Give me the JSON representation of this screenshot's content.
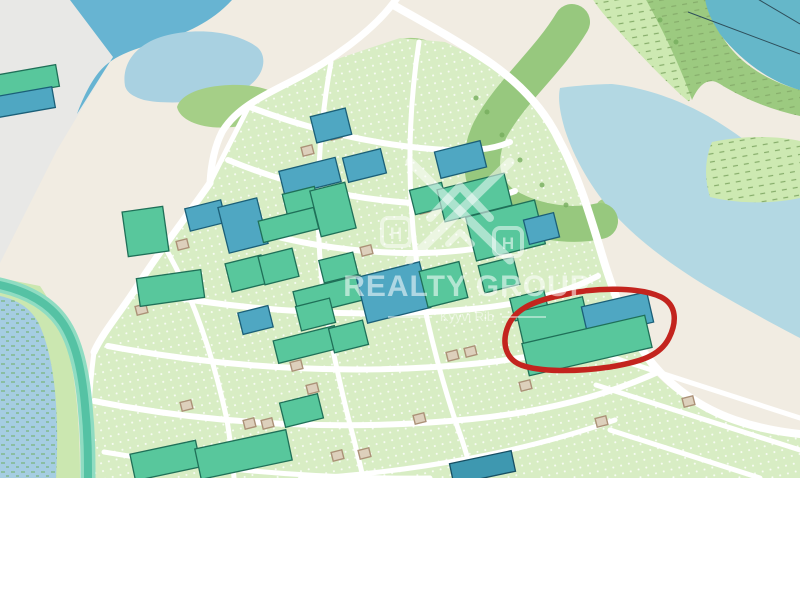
{
  "map": {
    "kind": "street-map-screenshot",
    "viewport": {
      "width": 800,
      "height": 478
    },
    "watermark": {
      "title": "REALTY GROUP",
      "subtitle": "Kyyvi Rib",
      "logo": "double-roof-x-with-H-badges",
      "color": "#ffffff"
    },
    "annotation": {
      "type": "hand-drawn-ellipse",
      "color": "#c3241e",
      "path": "M563,295 C595,287 640,287 661,297 C677,305 677,322 669,338 C660,356 640,362 610,367 C575,372 540,372 521,365 C506,359 502,344 507,329 C513,310 532,301 563,295 Z"
    },
    "colors": {
      "terrain": "#f1ece2",
      "industrial": "#e8e8e6",
      "water_dark": "#67b4d2",
      "pond": "#a9d1e1",
      "grass": "#a5cf87",
      "scrub": "#cde9b2",
      "bank": "#9cca80",
      "bank_band": "#97c87e",
      "water_teal": "#65b7c9",
      "river": "#b3d8e3",
      "plots": "#d8edc4",
      "wetland_blue": "#a5cde2",
      "wetland_green": "#cbe7b0",
      "canal": "#55c2a4",
      "canal_edge": "#8fdcc2",
      "road": "#ffffff",
      "building_green": "#58c79c",
      "building_green_stroke": "#1f7058",
      "building_blue": "#4fa7c2",
      "building_blue_stroke": "#1b5f78",
      "building_dark": "#3e98b0",
      "building_dark_stroke": "#174f63",
      "shed_fill": "#ddd0bc",
      "shed_stroke": "#ab9177",
      "annotation_red": "#c3241e",
      "cable": "#2e4e5a",
      "page_background": "#ffffff"
    },
    "buildings": [
      [
        313,
        112,
        36,
        27,
        -14,
        "b"
      ],
      [
        281,
        164,
        58,
        25,
        -14,
        "b"
      ],
      [
        345,
        153,
        39,
        25,
        -14,
        "b"
      ],
      [
        437,
        146,
        47,
        27,
        -14,
        "b"
      ],
      [
        187,
        204,
        37,
        23,
        -14,
        "b"
      ],
      [
        223,
        202,
        40,
        47,
        -14,
        "b"
      ],
      [
        285,
        190,
        33,
        27,
        -14,
        "g"
      ],
      [
        315,
        186,
        36,
        47,
        -14,
        "g"
      ],
      [
        260,
        214,
        57,
        22,
        -14,
        "g"
      ],
      [
        412,
        186,
        33,
        25,
        -14,
        "g"
      ],
      [
        440,
        181,
        69,
        33,
        -14,
        "g"
      ],
      [
        470,
        208,
        71,
        45,
        -14,
        "g"
      ],
      [
        526,
        216,
        31,
        25,
        -14,
        "b"
      ],
      [
        125,
        209,
        41,
        45,
        -8,
        "g"
      ],
      [
        138,
        274,
        65,
        28,
        -8,
        "g"
      ],
      [
        228,
        259,
        37,
        29,
        -14,
        "g"
      ],
      [
        261,
        252,
        35,
        29,
        -14,
        "g"
      ],
      [
        321,
        256,
        35,
        23,
        -14,
        "g"
      ],
      [
        295,
        283,
        69,
        25,
        -14,
        "g"
      ],
      [
        298,
        302,
        35,
        25,
        -14,
        "g"
      ],
      [
        240,
        309,
        31,
        22,
        -14,
        "b"
      ],
      [
        275,
        333,
        63,
        23,
        -14,
        "g"
      ],
      [
        331,
        324,
        35,
        25,
        -14,
        "g"
      ],
      [
        361,
        269,
        65,
        47,
        -14,
        "b"
      ],
      [
        423,
        266,
        41,
        37,
        -14,
        "g"
      ],
      [
        481,
        261,
        36,
        28,
        -14,
        "g"
      ],
      [
        282,
        398,
        39,
        25,
        -14,
        "g"
      ],
      [
        132,
        447,
        67,
        27,
        -12,
        "g"
      ],
      [
        197,
        439,
        93,
        31,
        -12,
        "g"
      ],
      [
        451,
        457,
        63,
        21,
        -12,
        "d"
      ],
      [
        512,
        294,
        35,
        23,
        -14,
        "g"
      ],
      [
        519,
        304,
        68,
        33,
        -13,
        "g"
      ],
      [
        584,
        299,
        67,
        31,
        -13,
        "b"
      ],
      [
        524,
        329,
        126,
        33,
        -13,
        "g"
      ],
      [
        -6,
        70,
        64,
        22,
        -10,
        "g"
      ],
      [
        -8,
        92,
        62,
        21,
        -10,
        "b"
      ]
    ],
    "sheds": [
      [
        177,
        240
      ],
      [
        136,
        305
      ],
      [
        361,
        246
      ],
      [
        419,
        204
      ],
      [
        302,
        146
      ],
      [
        330,
        130
      ],
      [
        181,
        401
      ],
      [
        244,
        419
      ],
      [
        262,
        419
      ],
      [
        246,
        437
      ],
      [
        267,
        434
      ],
      [
        307,
        384
      ],
      [
        332,
        451
      ],
      [
        359,
        449
      ],
      [
        447,
        351
      ],
      [
        465,
        347
      ],
      [
        291,
        361
      ],
      [
        414,
        414
      ],
      [
        520,
        381
      ],
      [
        683,
        397
      ],
      [
        596,
        417
      ]
    ]
  }
}
